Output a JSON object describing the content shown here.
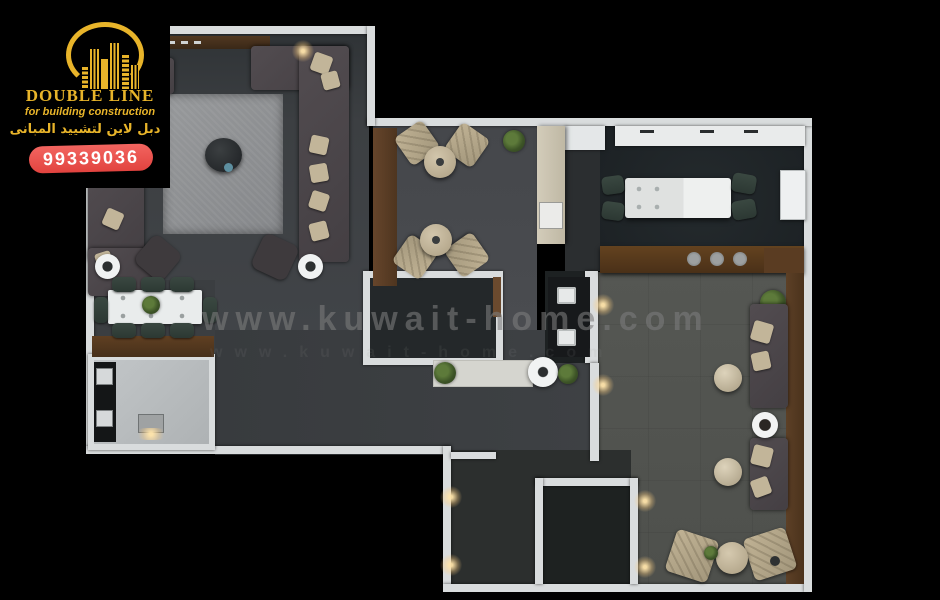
{
  "logo": {
    "company": "DOUBLE LINE",
    "tagline": "for building construction",
    "arabic_name": "دبل لاين لتشييد المبانى",
    "phone": "99339036"
  },
  "watermark": {
    "text": "www.kuwait-home.com",
    "text_faint": "www.kuwait-home.com"
  },
  "colors": {
    "background": "#000000",
    "logo_gold": "#E8B42A",
    "badge_red": "#E2433F",
    "badge_text": "#FFFFFF",
    "wall_white": "#D9DCDD",
    "wood_brown": "#5C3F27",
    "floor_gray": "#3B3E40",
    "floor_dining_dark": "#20252A",
    "floor_family": "#52544F",
    "floor_utility_light": "#B8BCBE",
    "rug_gray": "#8E9092",
    "sofa_dark": "#4B4549",
    "chair_green": "#33413B",
    "chair_beige": "#B7AA8E",
    "watermark_gray": "#7D7D7D"
  }
}
